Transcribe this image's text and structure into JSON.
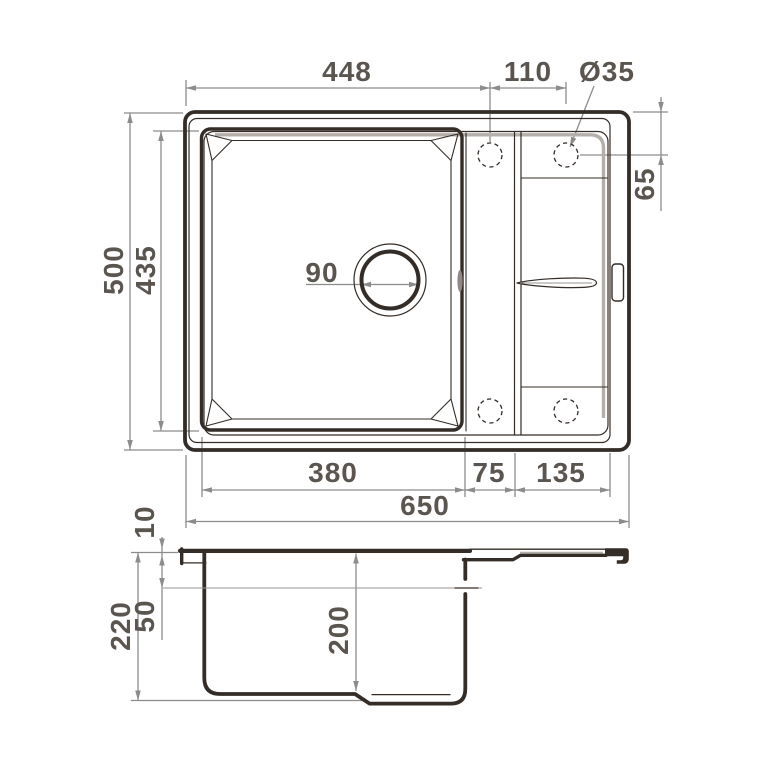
{
  "drawing": {
    "description": "kitchen sink technical drawing, top view and side section view",
    "colors": {
      "line": "#342c26",
      "dimension": "#8c8c8c",
      "label": "#5a554f",
      "shadow": "#b5afa9",
      "background": "#ffffff"
    },
    "dims": {
      "top_span": "448",
      "hole_spacing": "110",
      "hole_diameter": "Ø35",
      "depth_overall": "500",
      "depth_inner": "435",
      "drain_diameter": "90",
      "hole_offset": "65",
      "bowl_width": "380",
      "middle_width": "75",
      "wing_width": "135",
      "width_overall": "650",
      "rim_height": "10",
      "ledge_height": "50",
      "height_overall": "220",
      "bowl_depth": "200"
    }
  }
}
